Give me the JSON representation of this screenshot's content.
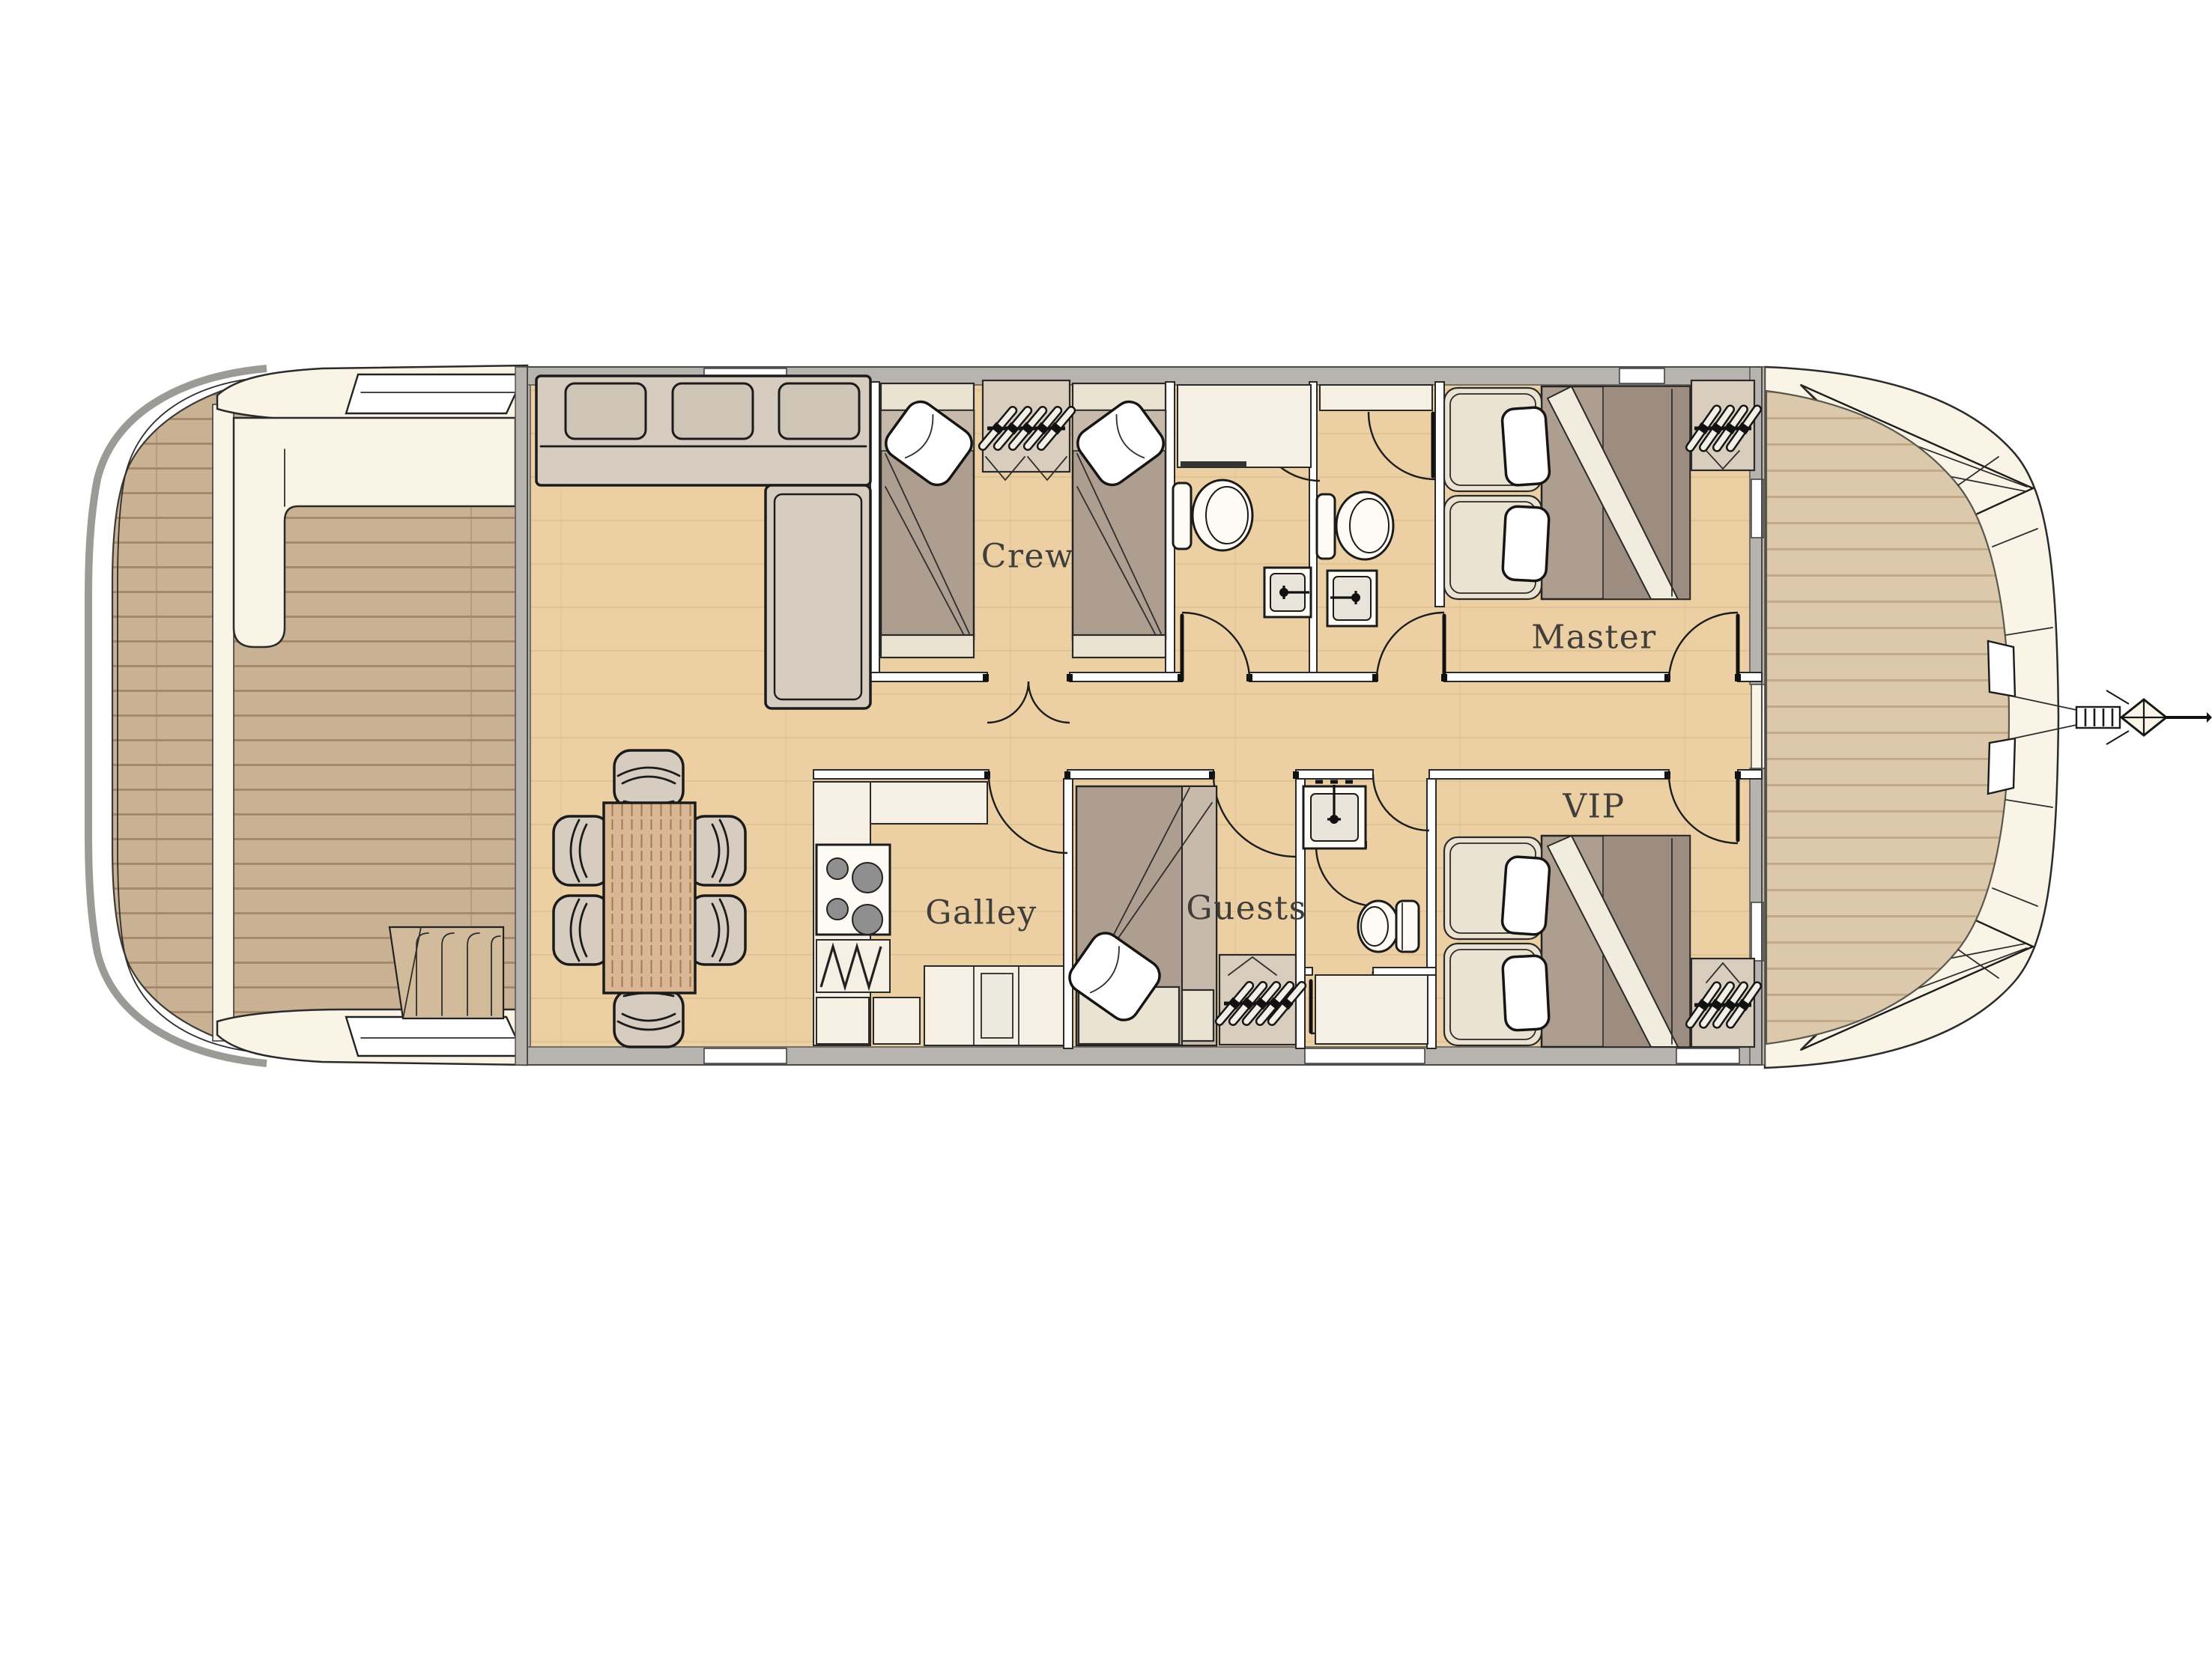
{
  "rooms": [
    {
      "id": "crew",
      "label": "Crew"
    },
    {
      "id": "galley",
      "label": "Galley"
    },
    {
      "id": "guests",
      "label": "Guests"
    },
    {
      "id": "master",
      "label": "Master"
    },
    {
      "id": "vip",
      "label": "VIP"
    }
  ],
  "furniture_icons": [
    "sofa",
    "chaise-longue",
    "dining-table",
    "dining-chair",
    "single-bed",
    "double-bed",
    "pillow",
    "wardrobe-hanger-rack",
    "stove",
    "galley-counter",
    "toilet",
    "sink",
    "shower",
    "door-swing",
    "stairs",
    "bench-seat",
    "anchor",
    "deck-hatch"
  ],
  "palette": {
    "bg": "#ffffff",
    "teak-aft": "#c9b194",
    "teak-aft-line": "#a5896a",
    "teak-bow": "#dcc9ab",
    "teak-bow-line": "#c2a987",
    "oak-floor": "#ecd0a4",
    "oak-line": "#d9b98b",
    "cream": "#faf4e6",
    "counter": "#f5f0e3",
    "wall-gray": "#b7b3ae",
    "furn": "#d6cdc0",
    "furn-light": "#cfc5b6",
    "duvet": "#ad9e8f",
    "duvet-light": "#c7baab",
    "duvet-dark": "#9c8d80",
    "headboard": "#ebe3d2",
    "table-wood": "#d9b795",
    "fixture": "#fdfbf4",
    "label": "#403e3b"
  }
}
